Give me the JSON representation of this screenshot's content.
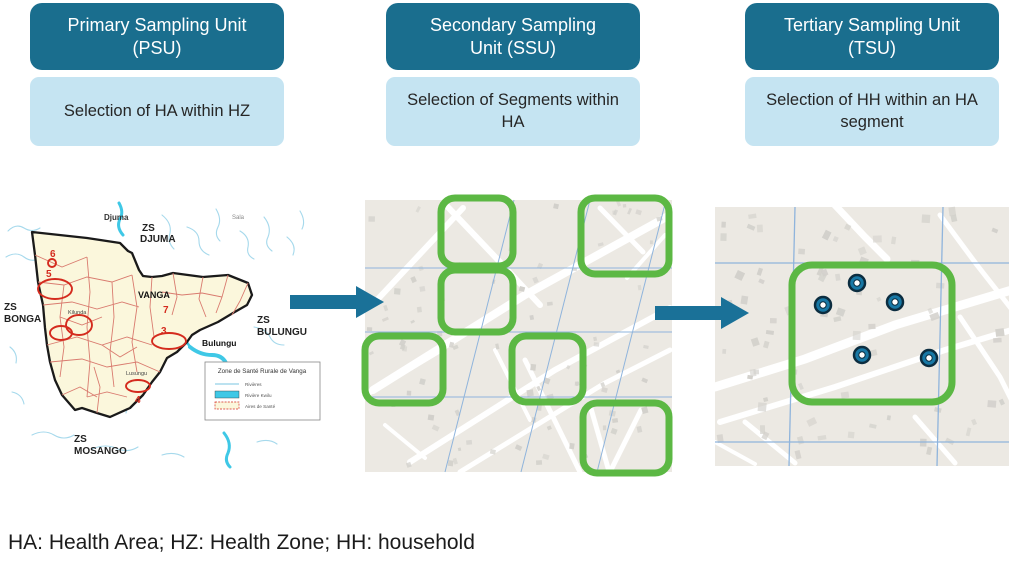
{
  "columns": [
    {
      "title": "Primary Sampling Unit (PSU)",
      "subtitle": "Selection of HA within HZ"
    },
    {
      "title": "Secondary Sampling Unit (SSU)",
      "subtitle": "Selection of Segments within HA"
    },
    {
      "title": "Tertiary Sampling Unit (TSU)",
      "subtitle": "Selection of HH within an HA segment"
    }
  ],
  "footer": {
    "note": "HA: Health Area; HZ: Health Zone; HH: household"
  },
  "colors": {
    "header_bg": "#1A6E8E",
    "header_text": "#FFFFFF",
    "subtitle_bg": "#C5E4F2",
    "subtitle_text": "#262626",
    "arrow": "#1A7198",
    "segment_outline": "#5CB844",
    "household_fill": "#1878A5",
    "household_dark": "#0C2D40",
    "map_bg": "#ECE9E3",
    "map_road": "#FFFFFF",
    "map_building": "#D2D0CB",
    "map_grid": "#8FB4DC",
    "zone_fill": "#FBF7DC",
    "zone_border": "#1A1A1A",
    "health_area_boundary": "#D97B6F",
    "selection_red": "#D42B1E",
    "river": "#A6D9EC",
    "river_kwilu": "#3FC8E6"
  },
  "psu_map": {
    "name": "Vanga health zone map",
    "labels": [
      {
        "text": "Djuma",
        "x": 102,
        "y": 23,
        "size": 8,
        "color": "#333333",
        "bold": true
      },
      {
        "text": "ZS",
        "x": 140,
        "y": 34,
        "size": 10,
        "color": "#222222",
        "bold": true
      },
      {
        "text": "DJUMA",
        "x": 138,
        "y": 45,
        "size": 10,
        "color": "#222222",
        "bold": true
      },
      {
        "text": "Sala",
        "x": 230,
        "y": 22,
        "size": 6,
        "color": "#888888",
        "bold": false
      },
      {
        "text": "ZS",
        "x": 2,
        "y": 113,
        "size": 10,
        "color": "#222222",
        "bold": true
      },
      {
        "text": "BONGA",
        "x": 2,
        "y": 125,
        "size": 10,
        "color": "#222222",
        "bold": true
      },
      {
        "text": "VANGA",
        "x": 136,
        "y": 101,
        "size": 9,
        "color": "#111111",
        "bold": true
      },
      {
        "text": "ZS",
        "x": 255,
        "y": 126,
        "size": 10,
        "color": "#222222",
        "bold": true
      },
      {
        "text": "BULUNGU",
        "x": 255,
        "y": 138,
        "size": 10,
        "color": "#222222",
        "bold": true
      },
      {
        "text": "Bulungu",
        "x": 200,
        "y": 149,
        "size": 8.5,
        "color": "#111111",
        "bold": true
      },
      {
        "text": "ZS",
        "x": 72,
        "y": 245,
        "size": 10,
        "color": "#222222",
        "bold": true
      },
      {
        "text": "MOSANGO",
        "x": 72,
        "y": 257,
        "size": 10,
        "color": "#222222",
        "bold": true
      },
      {
        "text": "Kilunda",
        "x": 66,
        "y": 117,
        "size": 5.5,
        "color": "#444444",
        "bold": false
      },
      {
        "text": "Lusungu",
        "x": 124,
        "y": 178,
        "size": 5.5,
        "color": "#444444",
        "bold": false
      }
    ],
    "selected_areas": [
      {
        "number": "6",
        "nx": 48,
        "ny": 60,
        "ellipse": {
          "cx": 50,
          "cy": 66,
          "rx": 4,
          "ry": 4
        }
      },
      {
        "number": "5",
        "nx": 44,
        "ny": 80,
        "ellipse": {
          "cx": 53,
          "cy": 92,
          "rx": 17,
          "ry": 10
        }
      },
      {
        "number": "",
        "nx": 0,
        "ny": 0,
        "ellipse": {
          "cx": 77,
          "cy": 128,
          "rx": 13,
          "ry": 10
        }
      },
      {
        "number": "",
        "nx": 0,
        "ny": 0,
        "ellipse": {
          "cx": 59,
          "cy": 136,
          "rx": 11,
          "ry": 7
        }
      },
      {
        "number": "7",
        "nx": 161,
        "ny": 116,
        "ellipse": null
      },
      {
        "number": "3",
        "nx": 159,
        "ny": 137,
        "ellipse": {
          "cx": 167,
          "cy": 144,
          "rx": 17,
          "ry": 8
        }
      },
      {
        "number": "4",
        "nx": 133,
        "ny": 206,
        "ellipse": {
          "cx": 136,
          "cy": 189,
          "rx": 12,
          "ry": 6
        }
      }
    ],
    "legend": {
      "title": "Zone de Santé Rurale de Vanga",
      "items": [
        {
          "symbol": "river-line",
          "label": "Rivières"
        },
        {
          "symbol": "river-kwilu-swatch",
          "label": "Rivière Kwilu"
        },
        {
          "symbol": "health-area-swatch",
          "label": "Aires de Santé"
        }
      ]
    }
  },
  "ssu_map": {
    "segments": [
      {
        "x": 76,
        "y": -2,
        "w": 72,
        "h": 68
      },
      {
        "x": 76,
        "y": 70,
        "w": 72,
        "h": 62
      },
      {
        "x": 216,
        "y": -2,
        "w": 88,
        "h": 76
      },
      {
        "x": 0,
        "y": 136,
        "w": 78,
        "h": 67
      },
      {
        "x": 147,
        "y": 136,
        "w": 71,
        "h": 66
      },
      {
        "x": 218,
        "y": 203,
        "w": 86,
        "h": 70
      }
    ]
  },
  "tsu_map": {
    "segment": {
      "x": 77,
      "y": 58,
      "w": 160,
      "h": 137
    },
    "households": [
      {
        "x": 142,
        "y": 76
      },
      {
        "x": 108,
        "y": 98
      },
      {
        "x": 180,
        "y": 95
      },
      {
        "x": 147,
        "y": 148
      },
      {
        "x": 214,
        "y": 151
      }
    ]
  }
}
